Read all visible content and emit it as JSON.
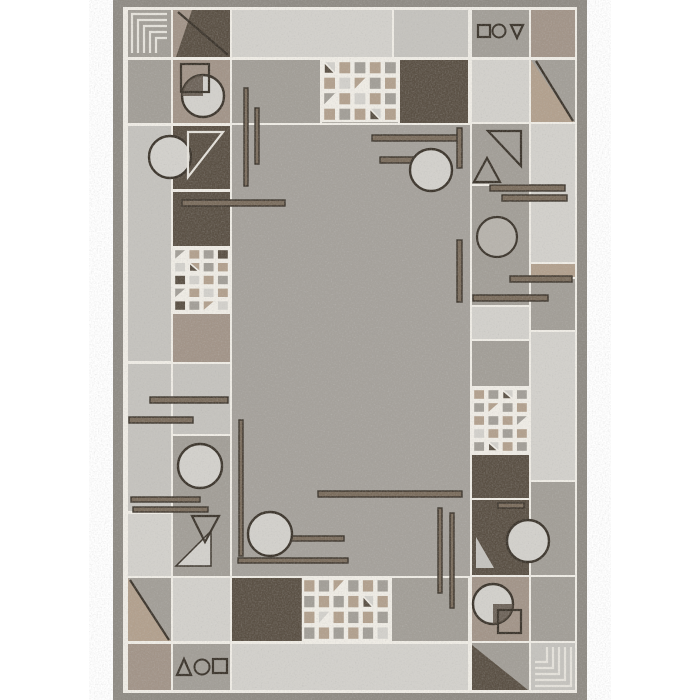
{
  "scene": {
    "kind": "rug-product-photo",
    "background": "#ffffff",
    "rug": {
      "x": 113,
      "y": 0,
      "w": 474,
      "h": 700
    }
  },
  "palette": {
    "field": "#a5a19b",
    "light": "#d3d1cc",
    "light2": "#c5c3be",
    "mid": "#a29e97",
    "mid2": "#b7b3ac",
    "taupe": "#a29488",
    "dark": "#5a5044",
    "beige": "#b2a08d",
    "binding": "#8f8b84",
    "grout": "#f0ede6",
    "line": "#3b342b",
    "lightline": "#e6e3dc",
    "barfill": "#7a6c5c"
  },
  "grout_rect": [
    123,
    7,
    454,
    686
  ],
  "tiles": [
    [
      128,
      10,
      43,
      47,
      "mid"
    ],
    [
      173,
      10,
      57,
      47,
      "taupe"
    ],
    [
      232,
      10,
      160,
      47,
      "light"
    ],
    [
      394,
      10,
      74,
      47,
      "light2"
    ],
    [
      472,
      10,
      57,
      47,
      "mid"
    ],
    [
      531,
      10,
      44,
      47,
      "taupe"
    ],
    [
      128,
      60,
      43,
      63,
      "mid"
    ],
    [
      173,
      60,
      57,
      63,
      "taupe"
    ],
    [
      232,
      60,
      88,
      63,
      "mid"
    ],
    [
      322,
      60,
      76,
      63,
      "mid"
    ],
    [
      400,
      60,
      68,
      63,
      "dark"
    ],
    [
      472,
      60,
      57,
      62,
      "light"
    ],
    [
      531,
      60,
      44,
      62,
      "mid"
    ],
    [
      232,
      125,
      238,
      451,
      "field"
    ],
    [
      128,
      126,
      43,
      235,
      "light2"
    ],
    [
      173,
      126,
      57,
      63,
      "dark"
    ],
    [
      173,
      192,
      57,
      54,
      "dark"
    ],
    [
      173,
      248,
      57,
      64,
      "dark"
    ],
    [
      173,
      314,
      57,
      48,
      "taupe"
    ],
    [
      173,
      364,
      57,
      70,
      "light2"
    ],
    [
      173,
      436,
      57,
      140,
      "mid"
    ],
    [
      128,
      364,
      43,
      147,
      "light2"
    ],
    [
      128,
      514,
      43,
      62,
      "light"
    ],
    [
      128,
      578,
      43,
      63,
      "mid"
    ],
    [
      128,
      644,
      43,
      46,
      "taupe"
    ],
    [
      173,
      578,
      57,
      63,
      "light"
    ],
    [
      173,
      644,
      57,
      46,
      "mid"
    ],
    [
      472,
      124,
      57,
      60,
      "mid"
    ],
    [
      472,
      186,
      57,
      119,
      "mid"
    ],
    [
      472,
      307,
      57,
      32,
      "light"
    ],
    [
      472,
      341,
      57,
      45,
      "mid"
    ],
    [
      472,
      388,
      57,
      65,
      "mid"
    ],
    [
      472,
      455,
      57,
      43,
      "dark"
    ],
    [
      472,
      500,
      57,
      75,
      "dark"
    ],
    [
      472,
      577,
      57,
      64,
      "taupe"
    ],
    [
      472,
      643,
      57,
      47,
      "mid"
    ],
    [
      531,
      124,
      44,
      138,
      "light"
    ],
    [
      531,
      264,
      44,
      13,
      "beige"
    ],
    [
      531,
      279,
      44,
      51,
      "mid"
    ],
    [
      531,
      332,
      44,
      148,
      "light"
    ],
    [
      531,
      482,
      44,
      93,
      "mid"
    ],
    [
      531,
      577,
      44,
      64,
      "mid"
    ],
    [
      531,
      643,
      44,
      47,
      "light2"
    ],
    [
      232,
      578,
      158,
      63,
      "dark"
    ],
    [
      392,
      578,
      76,
      63,
      "mid"
    ],
    [
      232,
      644,
      236,
      46,
      "light"
    ]
  ],
  "filled_polys": [
    {
      "pts": "192,10 230,10 230,57 176,57",
      "fill": "dark"
    },
    {
      "pts": "531,60 531,122 574,122",
      "fill": "beige"
    },
    {
      "pts": "128,578 128,641 171,641",
      "fill": "beige"
    },
    {
      "pts": "472,645 528,690 472,690",
      "fill": "dark"
    },
    {
      "pts": "476,537 494,568 476,568",
      "fill": "light2"
    },
    {
      "pts": "176,566 211,566 211,531",
      "fill": "light",
      "stroke": "line"
    }
  ],
  "diag_lines": [
    [
      178,
      12,
      228,
      55
    ],
    [
      536,
      61,
      573,
      121
    ],
    [
      130,
      580,
      169,
      640
    ]
  ],
  "outline_tris": [
    {
      "pts": "188,132 223,132 188,177",
      "stroke": "lightline"
    },
    {
      "pts": "488,131 521,131 521,166",
      "stroke": "line"
    },
    {
      "pts": "487,158 474,182 500,182",
      "stroke": "line"
    },
    {
      "pts": "192,516 219,516 205,542",
      "stroke": "line"
    },
    {
      "pts": "511,25 523,25 517,38",
      "stroke": "line"
    },
    {
      "pts": "177,675 184,659 191,675",
      "stroke": "line"
    }
  ],
  "bars": [
    [
      244,
      88,
      4,
      98
    ],
    [
      255,
      108,
      4,
      56
    ],
    [
      182,
      200,
      103,
      6
    ],
    [
      372,
      135,
      86,
      6
    ],
    [
      380,
      157,
      50,
      6
    ],
    [
      457,
      128,
      5,
      40
    ],
    [
      457,
      240,
      5,
      62
    ],
    [
      490,
      185,
      75,
      6
    ],
    [
      502,
      195,
      65,
      6
    ],
    [
      510,
      276,
      62,
      6
    ],
    [
      473,
      295,
      75,
      6
    ],
    [
      150,
      397,
      78,
      6
    ],
    [
      129,
      417,
      64,
      6
    ],
    [
      131,
      497,
      69,
      5
    ],
    [
      133,
      507,
      75,
      5
    ],
    [
      239,
      420,
      4,
      136
    ],
    [
      258,
      536,
      86,
      5
    ],
    [
      238,
      558,
      110,
      5
    ],
    [
      318,
      491,
      144,
      6
    ],
    [
      438,
      508,
      4,
      85
    ],
    [
      450,
      513,
      4,
      95
    ],
    [
      498,
      503,
      26,
      5
    ]
  ],
  "circles_filled": [
    [
      170,
      157,
      21
    ],
    [
      203,
      96,
      21
    ],
    [
      200,
      466,
      22
    ],
    [
      431,
      170,
      21
    ],
    [
      270,
      534,
      22
    ],
    [
      528,
      541,
      21
    ],
    [
      493,
      604,
      20
    ]
  ],
  "circles_ringfill": [
    [
      497,
      237,
      20
    ]
  ],
  "circles_outline": [
    [
      499,
      31,
      6.5
    ],
    [
      202,
      667,
      7.5
    ]
  ],
  "square_outlines": [
    [
      181,
      64,
      28,
      28
    ],
    [
      498,
      610,
      23,
      23
    ],
    [
      478,
      25,
      12,
      12
    ],
    [
      213,
      659,
      14,
      14
    ]
  ],
  "wedges": [
    "M203,96 L203,75 A21,21 0 0 0 182,96 Z",
    "M493,604 L493,624 A20,20 0 0 0 513,604 Z"
  ],
  "mazes": [
    {
      "x": 128,
      "y": 10,
      "w": 43,
      "h": 47,
      "corner": "tl",
      "n": 5,
      "step": 6
    },
    {
      "x": 531,
      "y": 643,
      "w": 44,
      "h": 47,
      "corner": "br",
      "n": 5,
      "step": 6
    }
  ],
  "quilts": [
    {
      "x": 173,
      "y": 248,
      "w": 57,
      "h": 64,
      "cols": 4,
      "rows": 5,
      "cells": [
        "m+t",
        "b",
        "m",
        "d",
        "l",
        "b+k",
        "m",
        "b",
        "d",
        "l",
        "b",
        "m",
        "m+t",
        "b",
        "l",
        "b",
        "d",
        "m",
        "b+t",
        "l"
      ]
    },
    {
      "x": 322,
      "y": 60,
      "w": 76,
      "h": 62,
      "cols": 5,
      "rows": 4,
      "cells": [
        "l+k",
        "b",
        "m",
        "b",
        "m",
        "b",
        "l",
        "b+t",
        "m",
        "b",
        "m+t",
        "b",
        "l",
        "b",
        "m",
        "b",
        "m",
        "b",
        "l+k",
        "b"
      ]
    },
    {
      "x": 472,
      "y": 388,
      "w": 57,
      "h": 65,
      "cols": 4,
      "rows": 5,
      "cells": [
        "b",
        "m",
        "l+k",
        "m",
        "m",
        "b+t",
        "m",
        "b",
        "b",
        "m",
        "b",
        "m+t",
        "l",
        "b",
        "m",
        "b",
        "m",
        "l+k",
        "b",
        "m"
      ]
    },
    {
      "x": 302,
      "y": 578,
      "w": 88,
      "h": 63,
      "cols": 6,
      "rows": 4,
      "cells": [
        "b",
        "m",
        "b+t",
        "m",
        "b",
        "m",
        "m",
        "b",
        "m",
        "b",
        "l+k",
        "b",
        "b",
        "l+t",
        "b",
        "m",
        "b",
        "m",
        "m",
        "b",
        "m",
        "b",
        "m",
        "l"
      ]
    }
  ]
}
